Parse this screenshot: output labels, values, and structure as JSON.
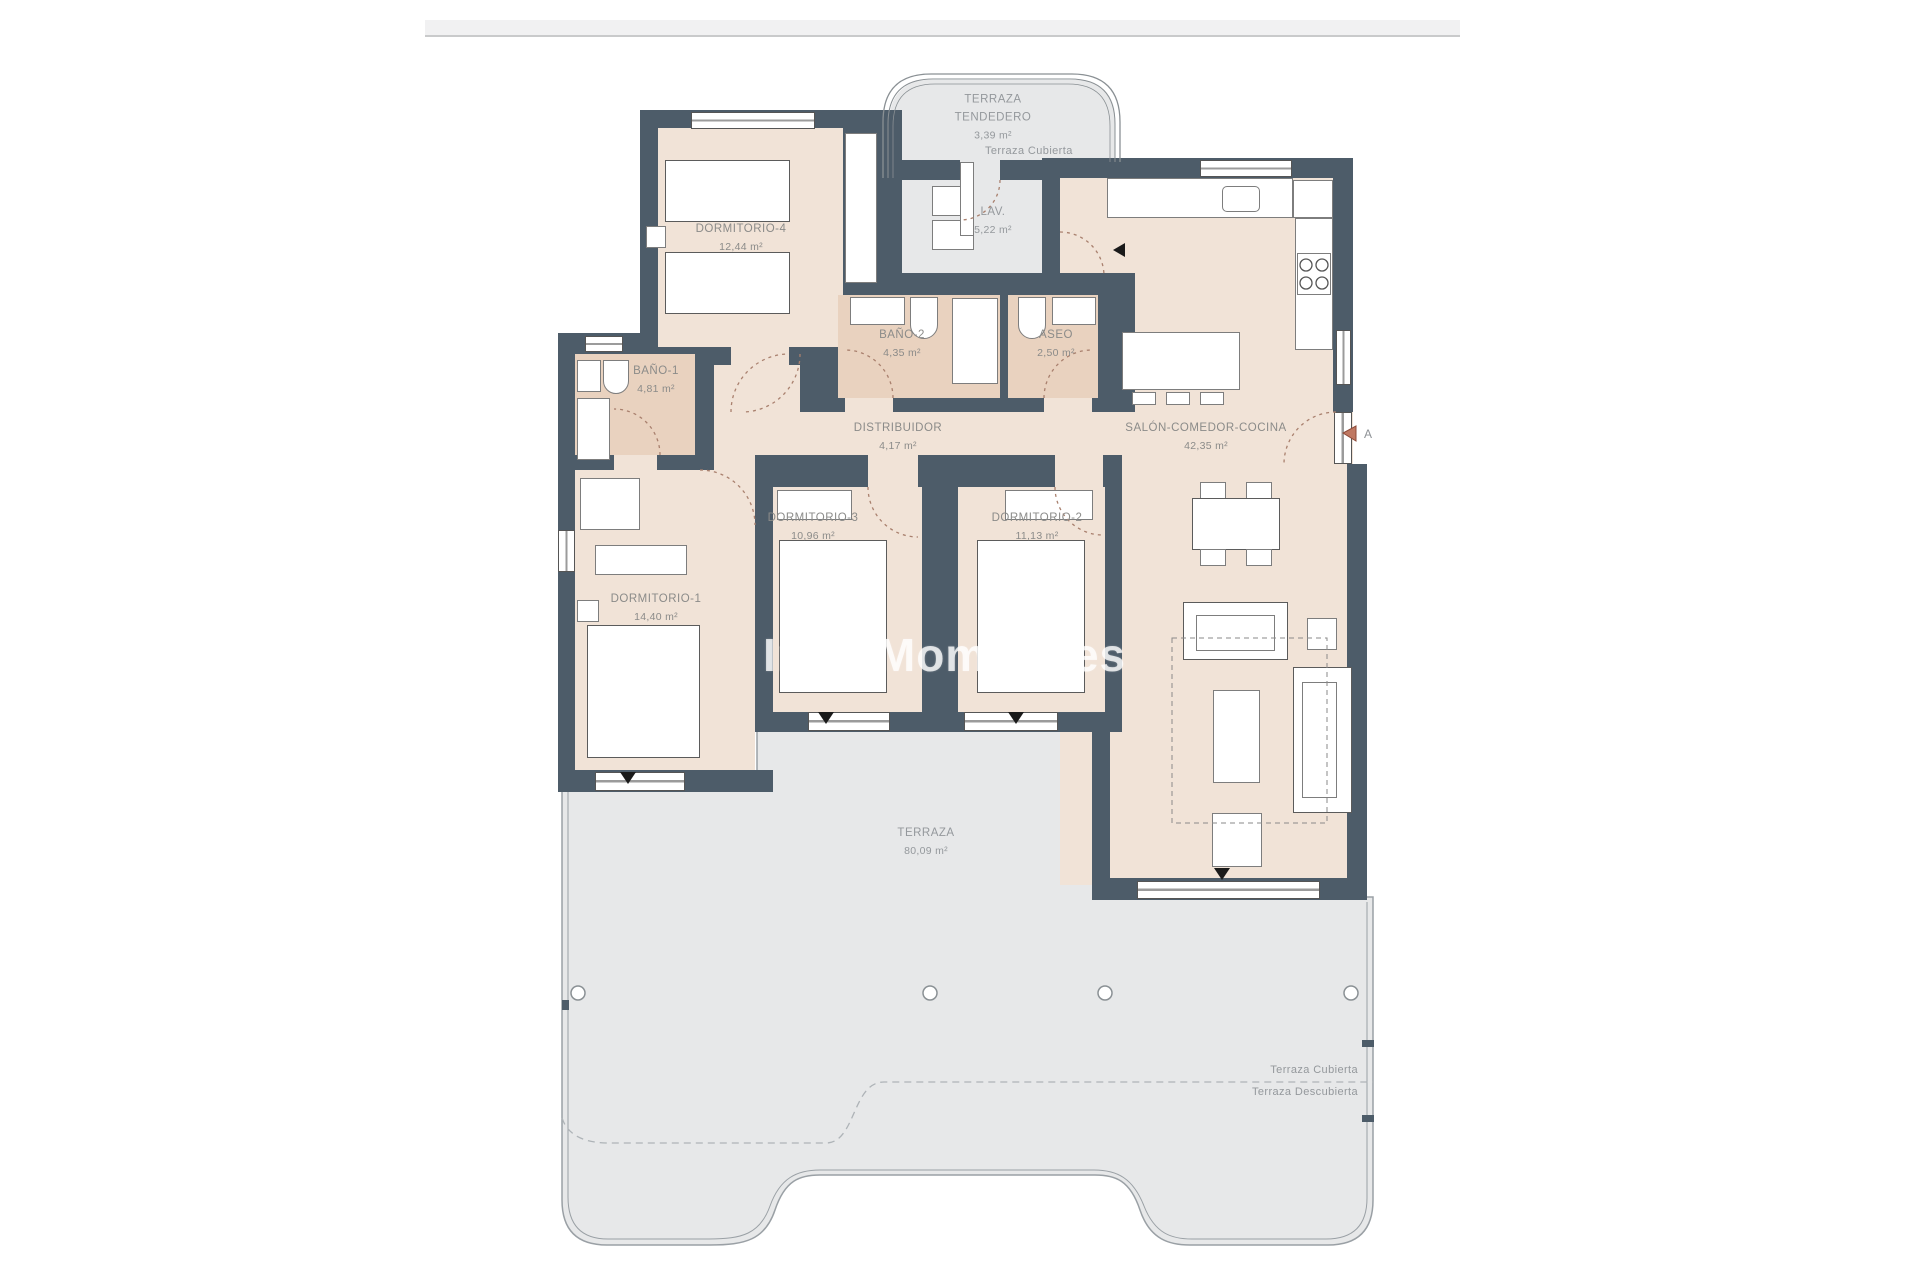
{
  "watermark": "InmoMoment.es",
  "rooms": [
    {
      "name": "TERRAZA TENDEDERO",
      "area": "3,39 m²"
    },
    {
      "name": "LAV.",
      "area": "5,22 m²"
    },
    {
      "name": "DORMITORIO-4",
      "area": "12,44 m²"
    },
    {
      "name": "BAÑO-1",
      "area": "4,81 m²"
    },
    {
      "name": "BAÑO-2",
      "area": "4,35 m²"
    },
    {
      "name": "ASEO",
      "area": "2,50 m²"
    },
    {
      "name": "DISTRIBUIDOR",
      "area": "4,17 m²"
    },
    {
      "name": "SALÓN-COMEDOR-COCINA",
      "area": "42,35 m²"
    },
    {
      "name": "DORMITORIO-3",
      "area": "10,96 m²"
    },
    {
      "name": "DORMITORIO-2",
      "area": "11,13 m²"
    },
    {
      "name": "DORMITORIO-1",
      "area": "14,40 m²"
    },
    {
      "name": "TERRAZA",
      "area": "80,09 m²"
    }
  ],
  "annotations": {
    "terraza_cubierta_top": "Terraza Cubierta",
    "terraza_cubierta_bottom": "Terraza Cubierta",
    "terraza_descubierta_bottom": "Terraza Descubierta",
    "entrance_letter": "A"
  },
  "colors": {
    "wall": "#4d5c69",
    "room_floor": "#f1e3d7",
    "bath_floor": "#e9d2bf",
    "terrace_floor": "#e7e8e9",
    "door_arc": "#a9806e",
    "entrance_marker": "#bf7862",
    "label_text": "#8b8b89"
  }
}
